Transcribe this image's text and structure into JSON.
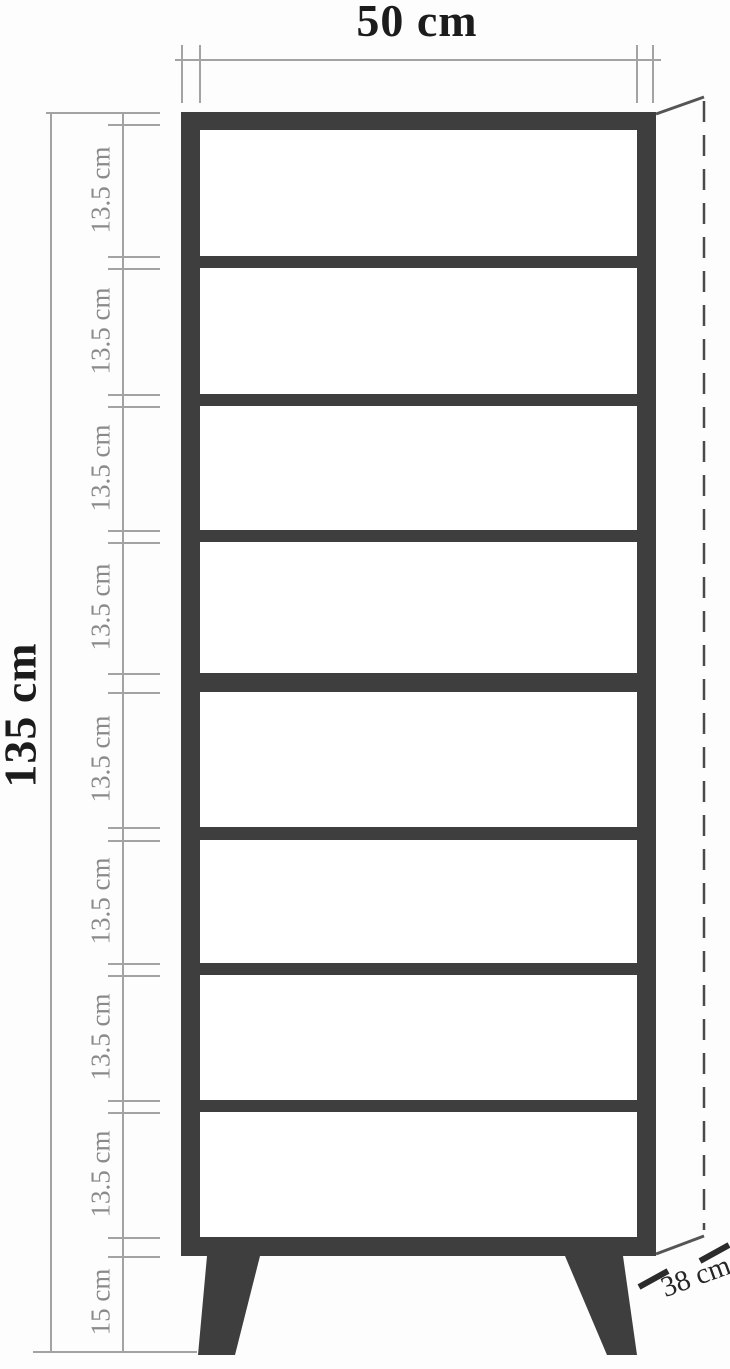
{
  "labels": {
    "top_width": "50 cm",
    "total_height": "135 cm",
    "shelf_sections": [
      "13.5 cm",
      "13.5 cm",
      "13.5 cm",
      "13.5 cm",
      "13.5 cm",
      "13.5 cm",
      "13.5 cm",
      "13.5 cm"
    ],
    "leg_height": "15 cm",
    "depth": "38 cm"
  },
  "structure": {
    "compartment_count": 8,
    "leg_count": 2
  },
  "colors": {
    "frame": "#3e3e3e",
    "dimension_line": "#a3a3a3",
    "primary_text": "#1c1c1c",
    "secondary_text": "#8a8a8a",
    "depth_text": "#262626"
  }
}
